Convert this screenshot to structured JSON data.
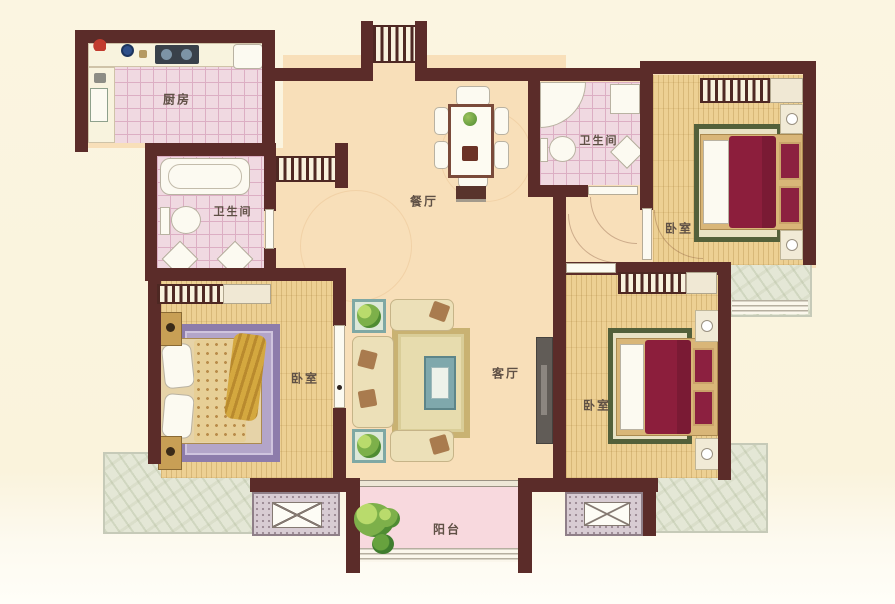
{
  "floorplan": {
    "type": "apartment-floor-plan",
    "rooms": [
      {
        "id": "kitchen",
        "label": "厨房"
      },
      {
        "id": "bathroom-1",
        "label": "卫生间"
      },
      {
        "id": "dining-room",
        "label": "餐厅"
      },
      {
        "id": "bathroom-2",
        "label": "卫生间"
      },
      {
        "id": "bedroom-1",
        "label": "卧室"
      },
      {
        "id": "bedroom-2",
        "label": "卧室"
      },
      {
        "id": "living-room",
        "label": "客厅"
      },
      {
        "id": "bedroom-3",
        "label": "卧室"
      },
      {
        "id": "balcony",
        "label": "阳台"
      }
    ],
    "colors": {
      "background": "#fbf5e1",
      "wall": "#5b2c29",
      "tile_pink": "#f0d9e1",
      "tile_grid": "#dcaec3",
      "floor_peach": "#f8dfb9",
      "floor_wood": "#edd093",
      "floor_balcony": "#f8d9de",
      "marble": "#e4e7d6",
      "bed_maroon": "#8c1e3c",
      "bed_tan": "#e7cf96",
      "rug_purple": "#b3a5c9",
      "rug_green": "#53603a",
      "sofa_cream": "#ece0b8",
      "accent_gold": "#c9b272",
      "fixture_white": "#fcfaf1",
      "label_text": "#5f5045"
    }
  }
}
